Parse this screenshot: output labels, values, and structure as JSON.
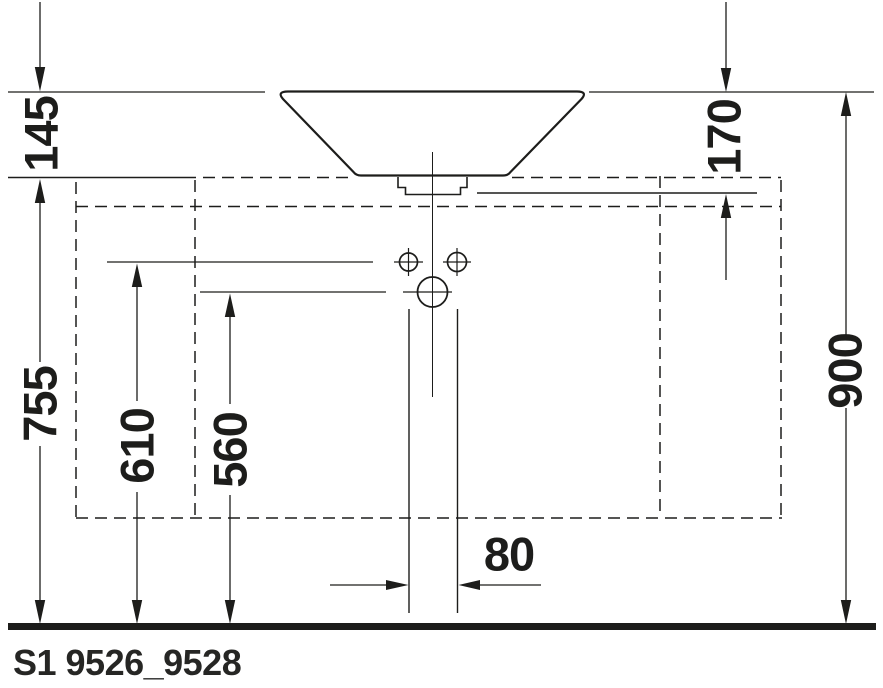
{
  "meta": {
    "drawing_code": "S1 9526_9528",
    "view": "front-elevation-technical-drawing"
  },
  "dimensions": {
    "basin_rim_above_console_top": "145",
    "basin_rim_to_console_underside": "170",
    "console_top_height_above_floor": "755",
    "upper_connection_height_above_floor": "610",
    "lower_connection_height_above_floor": "560",
    "overall_height_above_floor": "900",
    "pipe_duct_width": "80"
  },
  "colors": {
    "ink": "#1d1d1b",
    "background": "#ffffff"
  }
}
